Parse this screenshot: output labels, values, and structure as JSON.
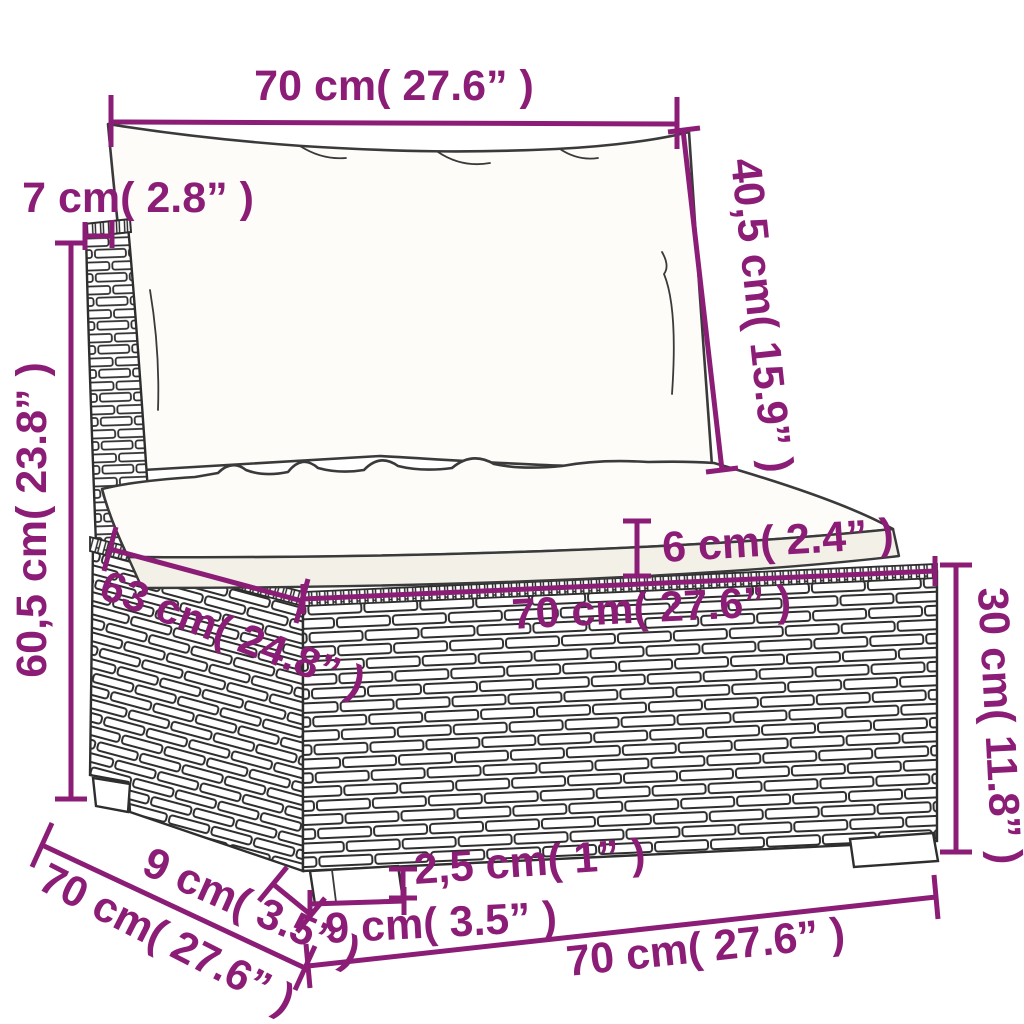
{
  "figure": {
    "type": "product-dimension-diagram",
    "product": "rattan-garden-sofa-middle-section-with-cushions",
    "accent_color": "#8c1d77",
    "line_color": "#2e2e2e",
    "background_color": "#ffffff"
  },
  "dimensions": [
    {
      "id": "back-width",
      "label": "70 cm( 27.6” )"
    },
    {
      "id": "frame-top-depth",
      "label": "7 cm( 2.8” )"
    },
    {
      "id": "back-cushion-height",
      "label": "40,5 cm( 15.9” )"
    },
    {
      "id": "backrest-height",
      "label": "60,5 cm( 23.8” )"
    },
    {
      "id": "seat-cushion-thickness",
      "label": "6 cm( 2.4” )"
    },
    {
      "id": "seat-depth",
      "label": "63 cm( 24.8” )"
    },
    {
      "id": "seat-front-width",
      "label": "70 cm( 27.6” )"
    },
    {
      "id": "base-height",
      "label": "30 cm( 11.8” )"
    },
    {
      "id": "side-leg-width",
      "label": "9 cm( 3.5” )"
    },
    {
      "id": "overall-depth",
      "label": "70 cm( 27.6” )"
    },
    {
      "id": "leg-height",
      "label": "2,5 cm( 1” )"
    },
    {
      "id": "front-leg-width",
      "label": "9 cm( 3.5” )"
    },
    {
      "id": "overall-width",
      "label": "70 cm( 27.6” )"
    }
  ]
}
